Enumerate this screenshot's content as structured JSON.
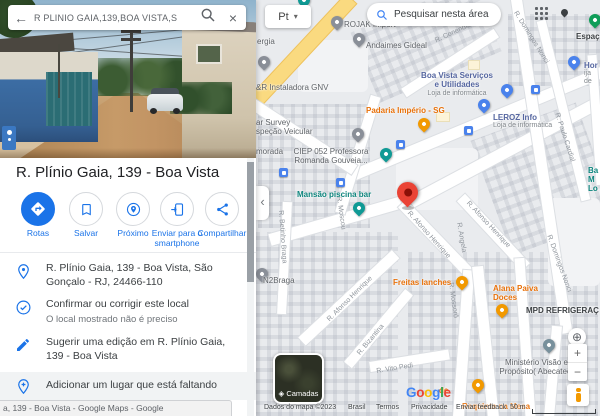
{
  "colors": {
    "accent_blue": "#1a73e8",
    "destination_pin": "#EA4335",
    "poi_blue": "#4a82ec",
    "poi_teal": "#0f9a95",
    "poi_orange": "#f29900",
    "poi_gray": "#8a8f98",
    "poi_green": "#0f9d58",
    "poi_church": "#78909c",
    "road_yellow": "#fada80"
  },
  "panel": {
    "search": {
      "value": "R PLINIO GAIA,139,BOA VISTA,S",
      "back_icon": "←",
      "close_icon": "×"
    },
    "title": "R. Plínio Gaia, 139 - Boa Vista",
    "actions": [
      {
        "label": "Rotas"
      },
      {
        "label": "Salvar"
      },
      {
        "label": "Próximo"
      },
      {
        "label": "Enviar para o smartphone"
      },
      {
        "label": "Compartilhar"
      }
    ],
    "info": [
      {
        "text": "R. Plínio Gaia, 139 - Boa Vista, São Gonçalo - RJ, 24466-110"
      },
      {
        "text": "Confirmar ou corrigir este local",
        "sub": "O local mostrado não é preciso"
      },
      {
        "text": "Sugerir uma edição em R. Plínio Gaia, 139 - Boa Vista"
      },
      {
        "text": "Adicionar um lugar que está faltando"
      }
    ],
    "status_bar": "a, 139 - Boa Vista - Google Maps - Google"
  },
  "map": {
    "language_chip": "Pt",
    "language_caret": "▾",
    "search_area_button": "Pesquisar nesta área",
    "collapse_chevron": "‹",
    "my_location_icon": "⊕",
    "zoom_in": "+",
    "zoom_out": "−",
    "layers_label": "Camadas",
    "layers_icon": "◈",
    "scale_label": "50 m",
    "google": "Google",
    "google_letters": [
      [
        "G",
        "#4285F4"
      ],
      [
        "o",
        "#EA4335"
      ],
      [
        "o",
        "#FBBC05"
      ],
      [
        "g",
        "#4285F4"
      ],
      [
        "l",
        "#34A853"
      ],
      [
        "e",
        "#EA4335"
      ]
    ],
    "attribution": [
      "Dados do mapa ©2023",
      "Brasil",
      "Termos",
      "Privacidade",
      "Enviar feedback"
    ],
    "pois": [
      {
        "label": "ROJAK Import",
        "type": "gray"
      },
      {
        "label": "Andaimes Gideal",
        "type": "gray"
      },
      {
        "label": "ergia",
        "type": "gray"
      },
      {
        "label": "&R Instaladora GNV",
        "type": "gray"
      },
      {
        "label": "Boa Vista Serviços\ne Utilidades",
        "sub": "Loja de informática",
        "type": "blue"
      },
      {
        "label": "Padaria Império - SG",
        "type": "orange"
      },
      {
        "label": "LEROZ Info",
        "sub": "Loja de informática",
        "type": "blue"
      },
      {
        "label": "ar Survey\nspeção Veicular",
        "type": "gray"
      },
      {
        "label": "morada",
        "type": "gray"
      },
      {
        "label": "CIEP 052 Professora\nRomanda Gouveia...",
        "type": "gray"
      },
      {
        "label": "Mansão piscina bar",
        "type": "teal"
      },
      {
        "label": "N2Braga",
        "type": "gray"
      },
      {
        "label": "Freitas lanches",
        "type": "orange"
      },
      {
        "label": "Alana Paiva\nDoces",
        "type": "orange"
      },
      {
        "label": "MPD REFRIGERAÇ",
        "type": "dark"
      },
      {
        "label": "Ministério Visão e\nPropósito( Abecatec)",
        "type": "gray"
      },
      {
        "label": "Requinte na Mesa",
        "type": "orange"
      },
      {
        "label": "de",
        "type": "orange"
      },
      {
        "label": "Espaç",
        "type": "dark"
      },
      {
        "label": "Hor",
        "sub": "ija de",
        "type": "blue"
      },
      {
        "label": "Ba\nM\nLo",
        "type": "teal"
      }
    ],
    "streets": [
      {
        "label": "R. Conendia"
      },
      {
        "label": "R. Domingos Nonci"
      },
      {
        "label": "R. Paulo Cardial"
      },
      {
        "label": "R. Afonso Henrique"
      },
      {
        "label": "R. Afonso Henrique"
      },
      {
        "label": "R. Afonso Henrique"
      },
      {
        "label": "R. Angela"
      },
      {
        "label": "R. Mossoró"
      },
      {
        "label": "R. Bizantina"
      },
      {
        "label": "R. Vito Pedi"
      },
      {
        "label": "R. Domingos Nonci"
      },
      {
        "label": "R. Betinho Braga"
      },
      {
        "label": "R. Moscou"
      }
    ]
  }
}
